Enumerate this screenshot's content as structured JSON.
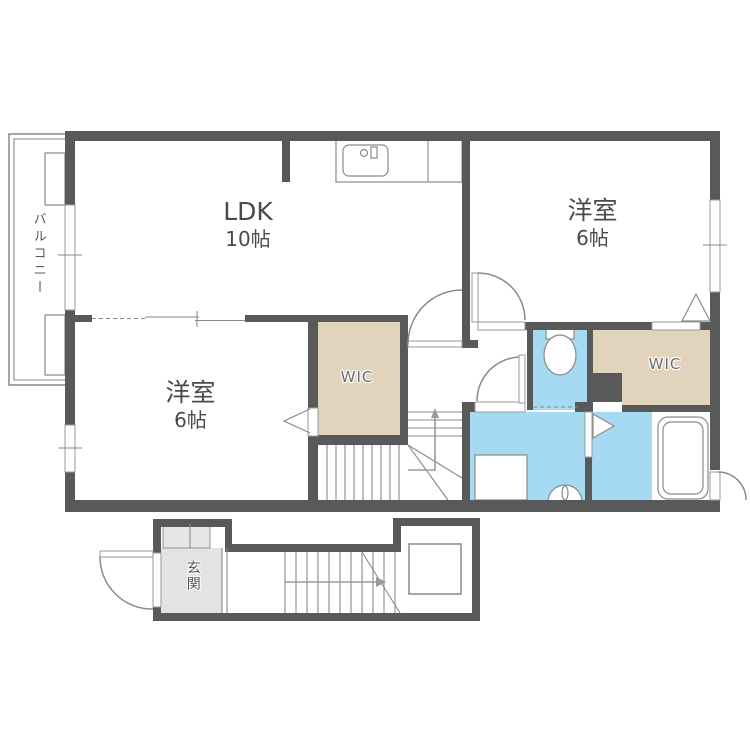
{
  "rooms": {
    "balcony": {
      "label": "バルコニー"
    },
    "ldk": {
      "label": "LDK",
      "size": "10帖"
    },
    "bedroom_right": {
      "label": "洋室",
      "size": "6帖"
    },
    "bedroom_left": {
      "label": "洋室",
      "size": "6帖"
    },
    "wic_left": {
      "label": "WIC"
    },
    "wic_right": {
      "label": "WIC"
    },
    "entrance": {
      "label": "玄関"
    }
  },
  "colors": {
    "wall": "#595959",
    "wet_area": "#a6d9f2",
    "closet": "#e2d3bc",
    "entrance_floor": "#e3e3e3",
    "cabinet": "#e6e6e6",
    "line": "#8a8a8a",
    "background": "#ffffff"
  }
}
